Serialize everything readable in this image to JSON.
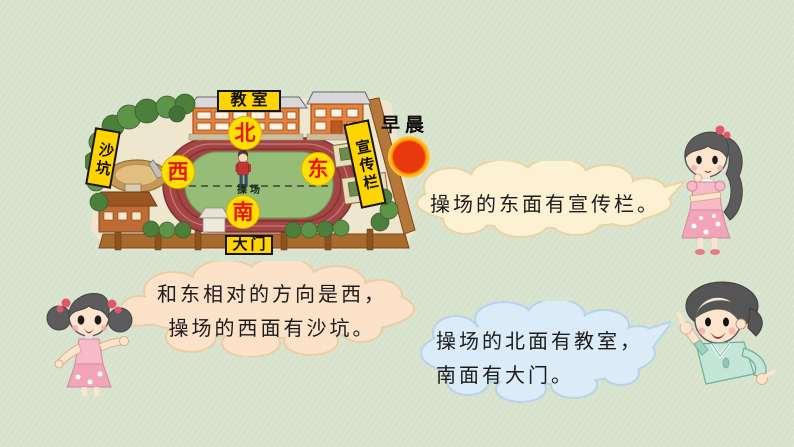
{
  "slide": {
    "time_label": "早晨"
  },
  "map": {
    "labels": {
      "classroom": "教室",
      "sandpit": "沙坑",
      "bulletin_board": "宣传栏",
      "gate": "大门",
      "playground": "操场"
    },
    "directions": {
      "north": "北",
      "west": "西",
      "east": "东",
      "south": "南"
    },
    "colors": {
      "label_bg": "#ffd400",
      "direction_text": "#e81515",
      "track": "#a34545",
      "infield": "#96bd77",
      "campus_ground": "#efe6cf",
      "wall": "#a96a2e",
      "tree": "#4c7f3c"
    }
  },
  "sun": {
    "core_color": "#e8380d",
    "glow_color": "#ffcf40"
  },
  "bubbles": {
    "east": {
      "text": "操场的东面有宣传栏。",
      "fill": "#fdf1d3",
      "outline": "#e9d4a4"
    },
    "west": {
      "line1": "和东相对的方向是西，",
      "line2": "操场的西面有沙坑。",
      "fill": "#fbe2c9",
      "outline": "#eccda4"
    },
    "north_south": {
      "line1": "操场的北面有教室，",
      "line2": "南面有大门。",
      "fill": "#dcebf8",
      "outline": "#b9d3e6"
    }
  }
}
